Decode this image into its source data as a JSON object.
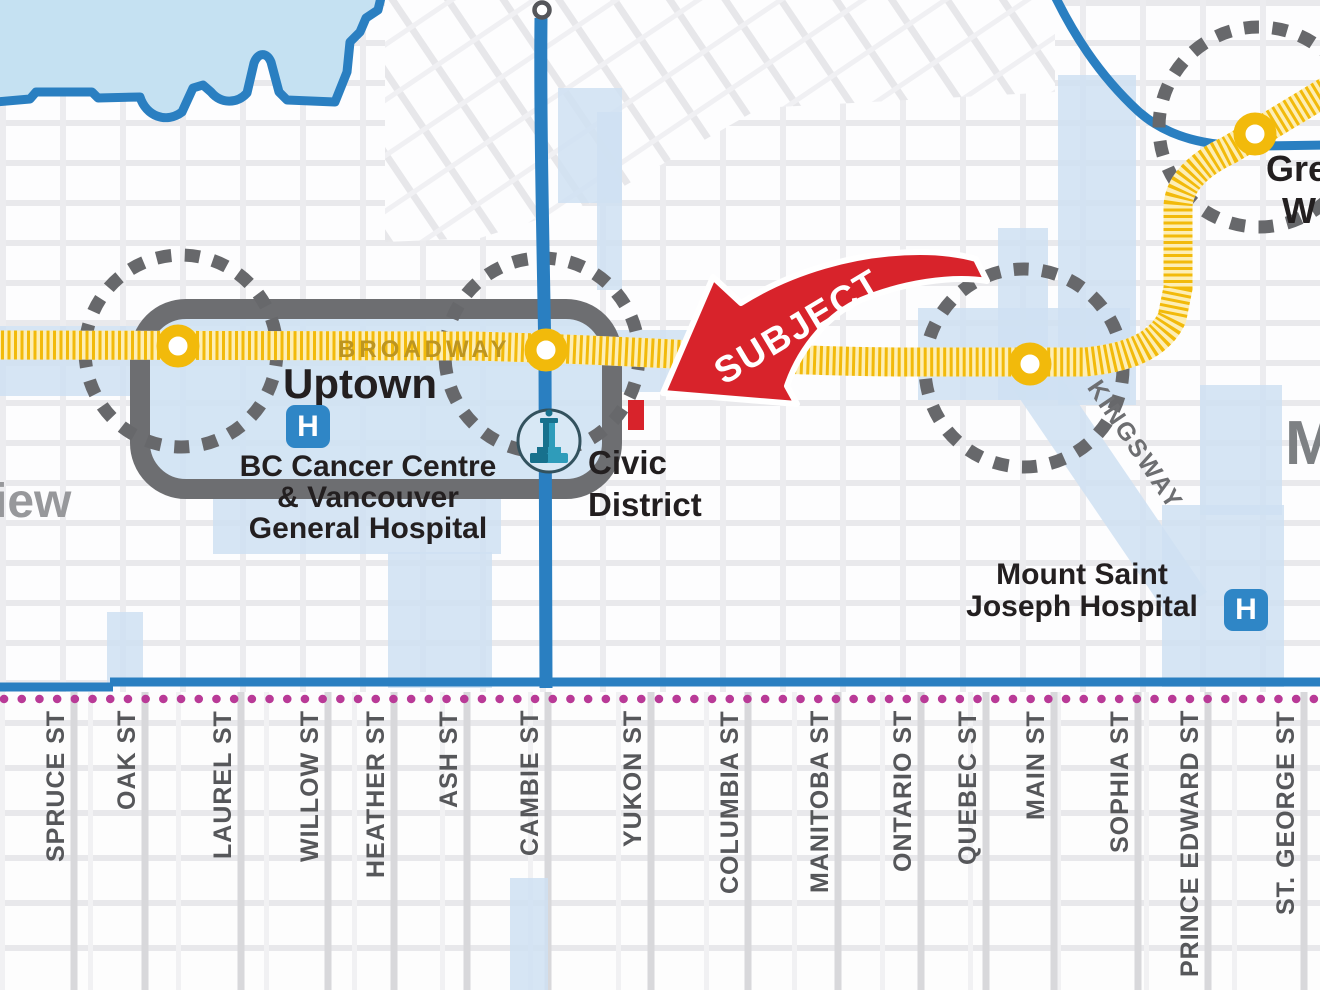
{
  "map": {
    "areas": {
      "uptown": "Uptown",
      "fairview_partial": "iew",
      "mount_pleasant_partial": "M"
    },
    "transit": {
      "broadway_line_label": "BROADWAY",
      "kingsway_label": "KINGSWAY",
      "great_northern_partial": {
        "line1": "Gre",
        "line2": "W"
      }
    },
    "places": {
      "hospital_icon_letter": "H",
      "bc_cancer": {
        "line1": "BC Cancer Centre",
        "line2": "& Vancouver",
        "line3": "General Hospital"
      },
      "civic_district": {
        "line1": "Civic",
        "line2": "District"
      },
      "mount_saint_joseph": {
        "line1": "Mount Saint",
        "line2": "Joseph Hospital"
      }
    },
    "annotation": {
      "subject_label": "SUBJECT"
    },
    "streets": [
      {
        "label": "SPRUCE ST",
        "x": 58
      },
      {
        "label": "OAK ST",
        "x": 129
      },
      {
        "label": "LAUREL ST",
        "x": 225
      },
      {
        "label": "WILLOW ST",
        "x": 312
      },
      {
        "label": "HEATHER ST",
        "x": 378
      },
      {
        "label": "ASH ST",
        "x": 451
      },
      {
        "label": "CAMBIE ST",
        "x": 532
      },
      {
        "label": "YUKON ST",
        "x": 635
      },
      {
        "label": "COLUMBIA ST",
        "x": 732
      },
      {
        "label": "MANITOBA ST",
        "x": 822
      },
      {
        "label": "ONTARIO ST",
        "x": 905
      },
      {
        "label": "QUEBEC ST",
        "x": 970
      },
      {
        "label": "MAIN ST",
        "x": 1038
      },
      {
        "label": "SOPHIA ST",
        "x": 1122
      },
      {
        "label": "PRINCE EDWARD ST",
        "x": 1192
      },
      {
        "label": "ST. GEORGE ST",
        "x": 1288
      }
    ],
    "colors": {
      "water": "#c5e1f2",
      "road_blue": "#2a7fc1",
      "corridor": "#cfe1f2",
      "line_yellow": "#f2ba0b",
      "line_yellow_pale": "#fdeeb5",
      "dash_gray": "#67686b",
      "box_gray": "#6d6e71",
      "boundary_magenta": "#b93a97",
      "subject_red": "#d8232b",
      "hospital_blue": "#2f86c6",
      "civic_teal": "#2f9cba",
      "broadway_gold": "#bd951f",
      "text_black": "#231f20",
      "text_gray": "#97989b"
    }
  }
}
